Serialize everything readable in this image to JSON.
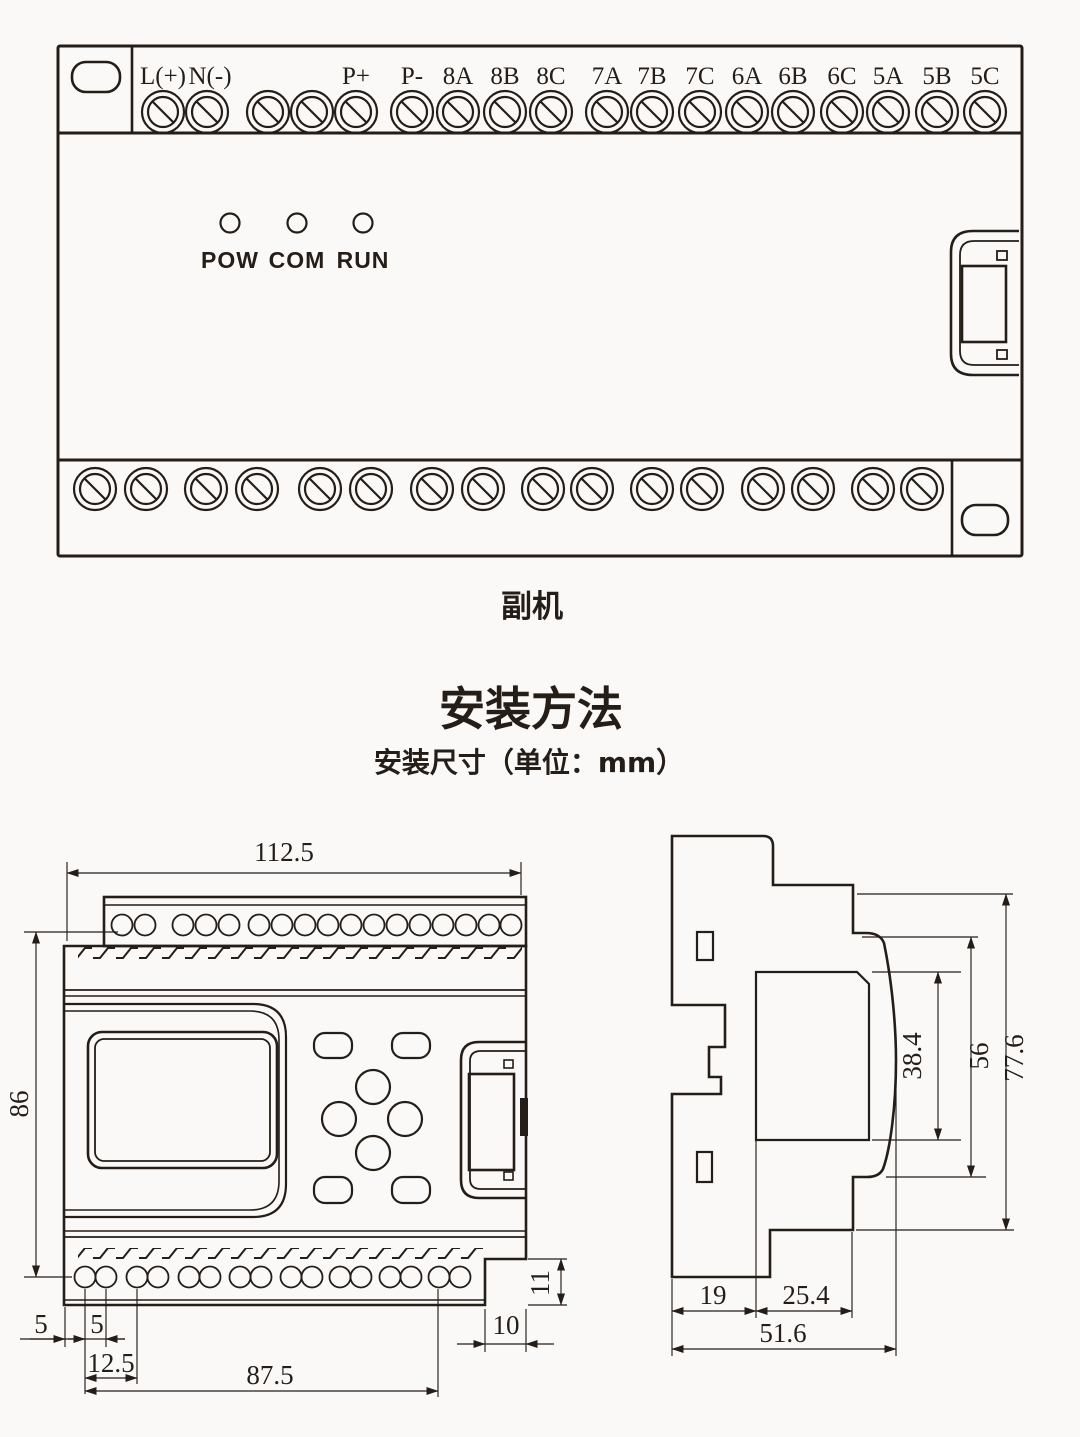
{
  "device": {
    "top_terminals": [
      "L(+)",
      "N(-)",
      "P+",
      "P-",
      "8A",
      "8B",
      "8C",
      "7A",
      "7B",
      "7C",
      "6A",
      "6B",
      "6C",
      "5A",
      "5B",
      "5C"
    ],
    "leds": [
      "POW",
      "COM",
      "RUN"
    ],
    "caption": "副机"
  },
  "install": {
    "title": "安装方法",
    "subtitle": "安装尺寸（单位：mm）"
  },
  "front_view": {
    "width": "112.5",
    "height": "86",
    "edge_offset": "5",
    "hole_pitch": "5",
    "pitch_12_5": "12.5",
    "span_87_5": "87.5",
    "notch_width": "10",
    "notch_height": "11"
  },
  "side_view": {
    "din_offset": "19",
    "front_depth": "25.4",
    "total_depth": "51.6",
    "panel_height": "38.4",
    "mid_height": "56",
    "total_height": "77.6"
  }
}
